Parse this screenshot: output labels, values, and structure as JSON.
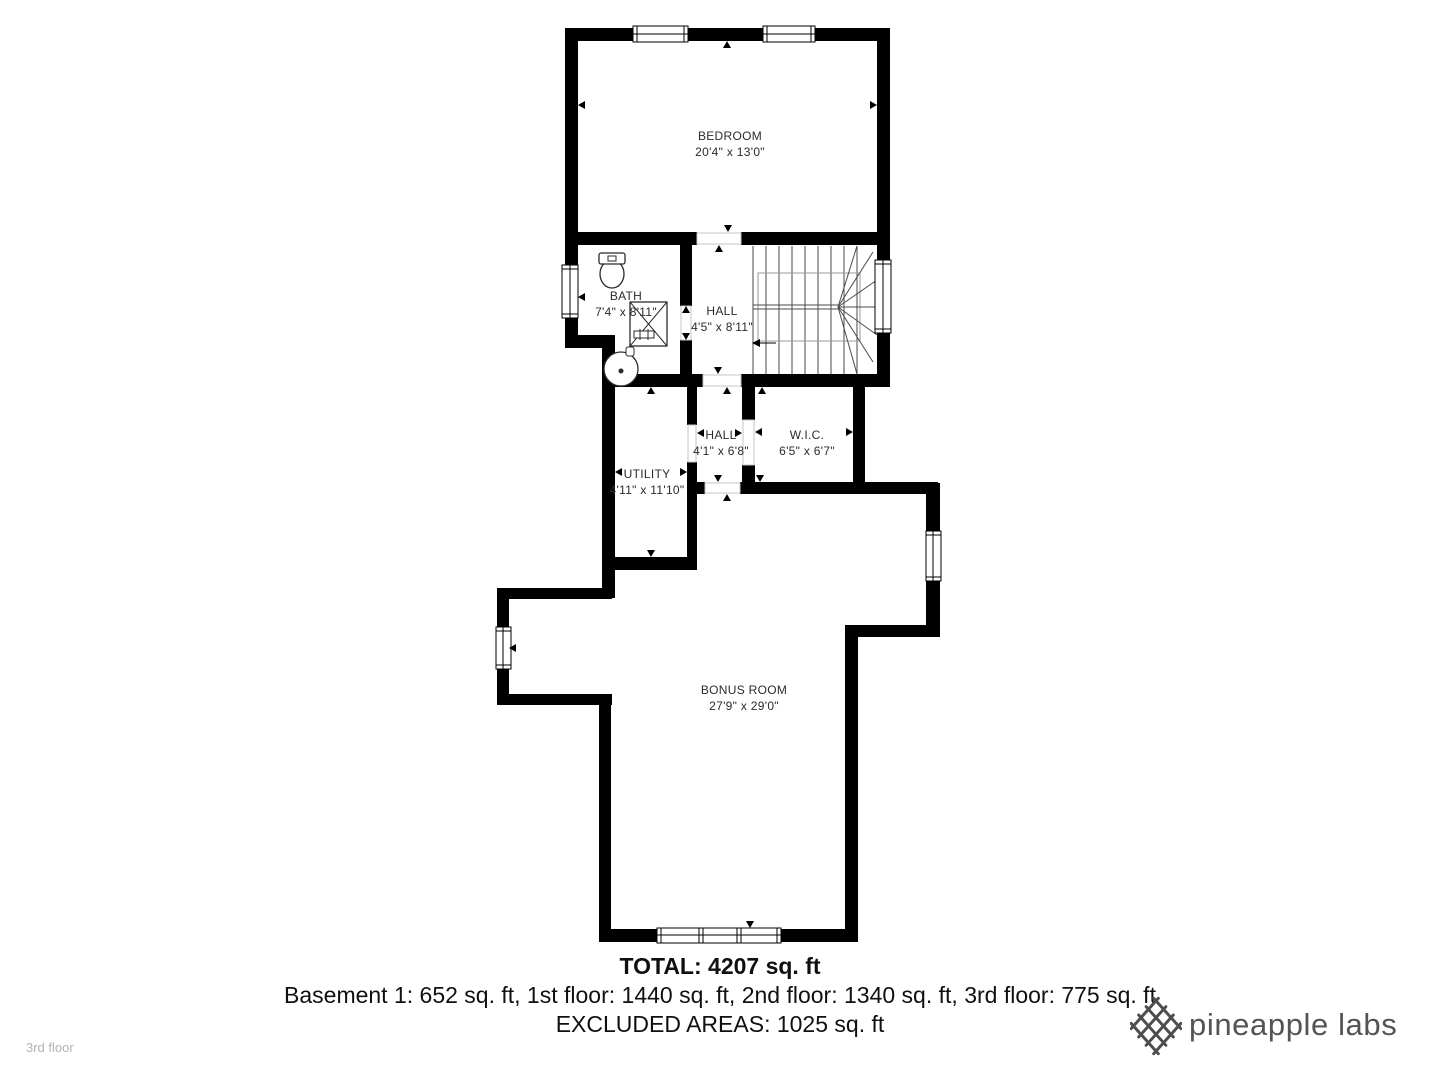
{
  "floor_plan": {
    "floor_label": "3rd floor",
    "rooms": [
      {
        "id": "bedroom",
        "name": "BEDROOM",
        "dims": "20'4\" x 13'0\""
      },
      {
        "id": "bath",
        "name": "BATH",
        "dims": "7'4\" x 8'11\""
      },
      {
        "id": "hall-upper",
        "name": "HALL",
        "dims": "4'5\" x 8'11\""
      },
      {
        "id": "hall-lower",
        "name": "HALL",
        "dims": "4'1\" x 6'8\""
      },
      {
        "id": "wic",
        "name": "W.I.C.",
        "dims": "6'5\" x 6'7\""
      },
      {
        "id": "utility",
        "name": "UTILITY",
        "dims": "4'11\" x 11'10\""
      },
      {
        "id": "bonus",
        "name": "BONUS ROOM",
        "dims": "27'9\" x 29'0\""
      }
    ]
  },
  "summary": {
    "total": "TOTAL: 4207 sq. ft",
    "floors": "Basement 1: 652 sq. ft, 1st floor: 1440 sq. ft, 2nd floor: 1340 sq. ft, 3rd floor: 775 sq. ft",
    "excluded": "EXCLUDED AREAS: 1025 sq. ft"
  },
  "branding": {
    "logo_text": "pineapple labs",
    "logo_icon": "crosshatch-pineapple-icon"
  },
  "colors": {
    "walls": "#000000",
    "room_text": "#2b2b2b",
    "summary_text": "#101010",
    "floor_label_text": "#b3b3b3",
    "logo": "#4d4d4d",
    "stair_lines": "#4a4a4a"
  }
}
